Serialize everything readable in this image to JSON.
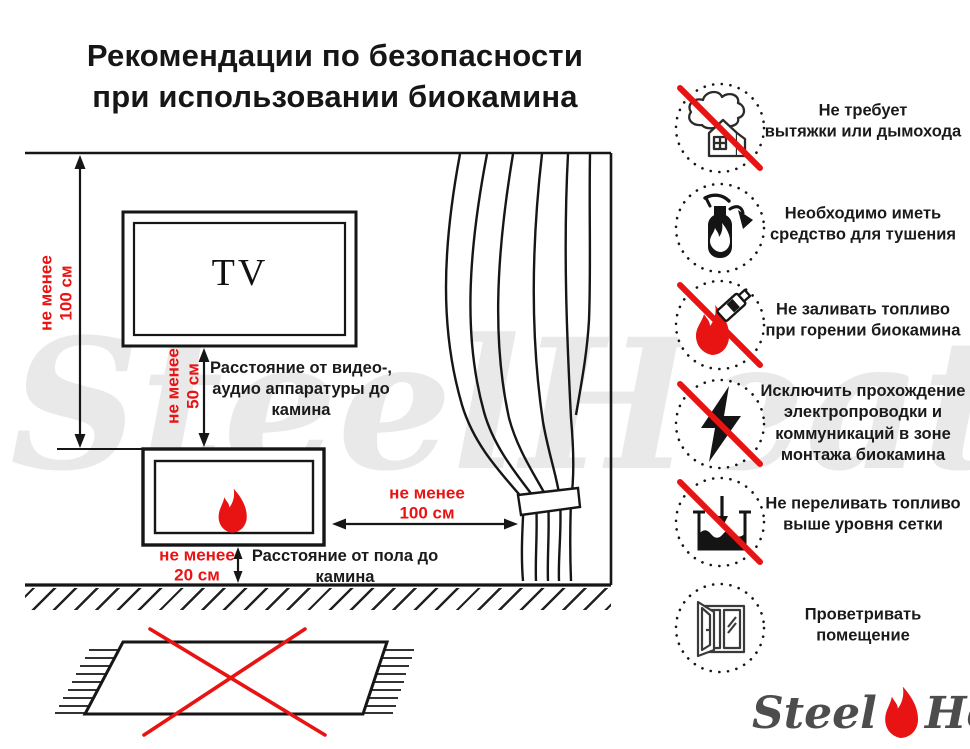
{
  "title": "Рекомендации по безопасности\nпри использовании биокамина",
  "colors": {
    "accent_red": "#e81313",
    "line_black": "#161616",
    "watermark_gray": "#e9e9e9",
    "logo_gray": "#4d4d4d"
  },
  "diagram": {
    "tv_label": "TV",
    "dim_wall_tv": "не менее\n100 см",
    "dim_tv_fireplace": "не менее\n50 см",
    "dim_fireplace_curtain": "не менее\n100 см",
    "dim_fireplace_floor": "не менее\n20 см",
    "label_av": "Расстояние от видео-,\nаудио аппаратуры до\nкамина",
    "label_floor": "Расстояние от пола до\nкамина"
  },
  "rules": [
    {
      "icon": "no-chimney",
      "crossed": true,
      "label": "Не требует\nвытяжки или дымохода"
    },
    {
      "icon": "extinguisher",
      "crossed": false,
      "label": "Необходимо иметь\nсредство для тушения"
    },
    {
      "icon": "no-refuel-while-burning",
      "crossed": true,
      "label": "Не заливать топливо\nпри горении биокамина"
    },
    {
      "icon": "no-wiring-in-zone",
      "crossed": true,
      "label": "Исключить прохождение\nэлектропроводки и\nкоммуникаций в зоне\nмонтажа биокамина"
    },
    {
      "icon": "no-overfill",
      "crossed": true,
      "label": "Не переливать топливо\nвыше уровня сетки"
    },
    {
      "icon": "ventilate-room",
      "crossed": false,
      "label": "Проветривать\nпомещение"
    }
  ],
  "watermark": {
    "left": "Steel",
    "right": "Heat"
  },
  "logo": {
    "left": "Steel",
    "right": "Heat"
  }
}
